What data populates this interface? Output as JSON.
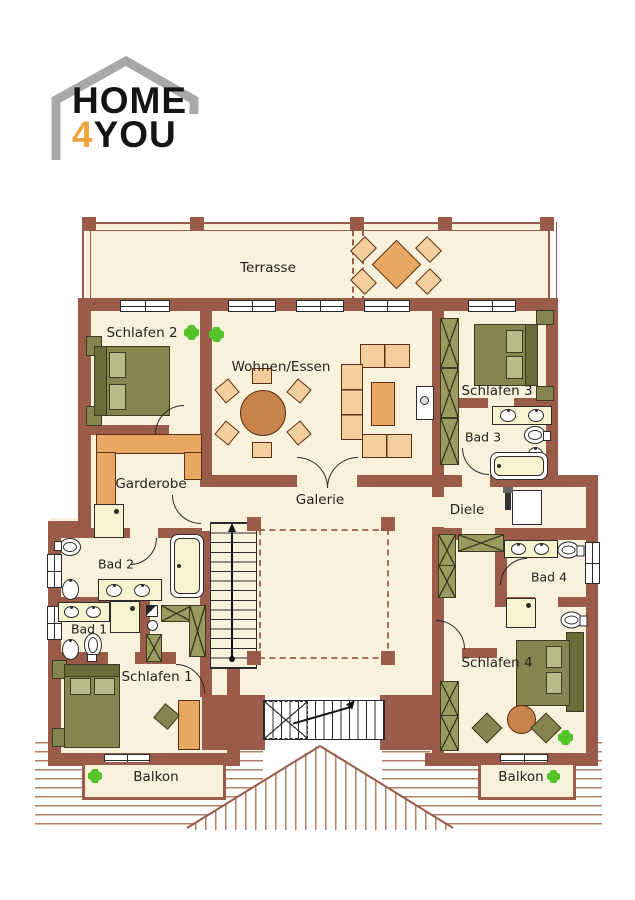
{
  "logo": {
    "word1": "HOME",
    "digit": "4",
    "word2": "YOU"
  },
  "rooms": {
    "terrasse": "Terrasse",
    "schlafen2": "Schlafen 2",
    "wohnen_essen": "Wohnen/Essen",
    "schlafen3": "Schlafen 3",
    "bad3": "Bad 3",
    "garderobe": "Garderobe",
    "galerie": "Galerie",
    "diele": "Diele",
    "bad2": "Bad 2",
    "bad1": "Bad 1",
    "schlafen1": "Schlafen 1",
    "bad4": "Bad 4",
    "schlafen4": "Schlafen 4",
    "balkon_left": "Balkon",
    "balkon_right": "Balkon"
  },
  "colors": {
    "wall": "#9a5b49",
    "floor": "#f8f1dc",
    "furniture": "#e9a862",
    "furniture_light": "#f4cf9e",
    "bed": "#84854f",
    "bed_dark": "#6b6c3c",
    "pillow": "#babb8b",
    "fixture": "#f6f3cf",
    "plant": "#55c42b",
    "roof_line": "#b08066",
    "logo_orange": "#f0a43c",
    "outline": "#2b2b2b",
    "label_text": "#26211c"
  }
}
